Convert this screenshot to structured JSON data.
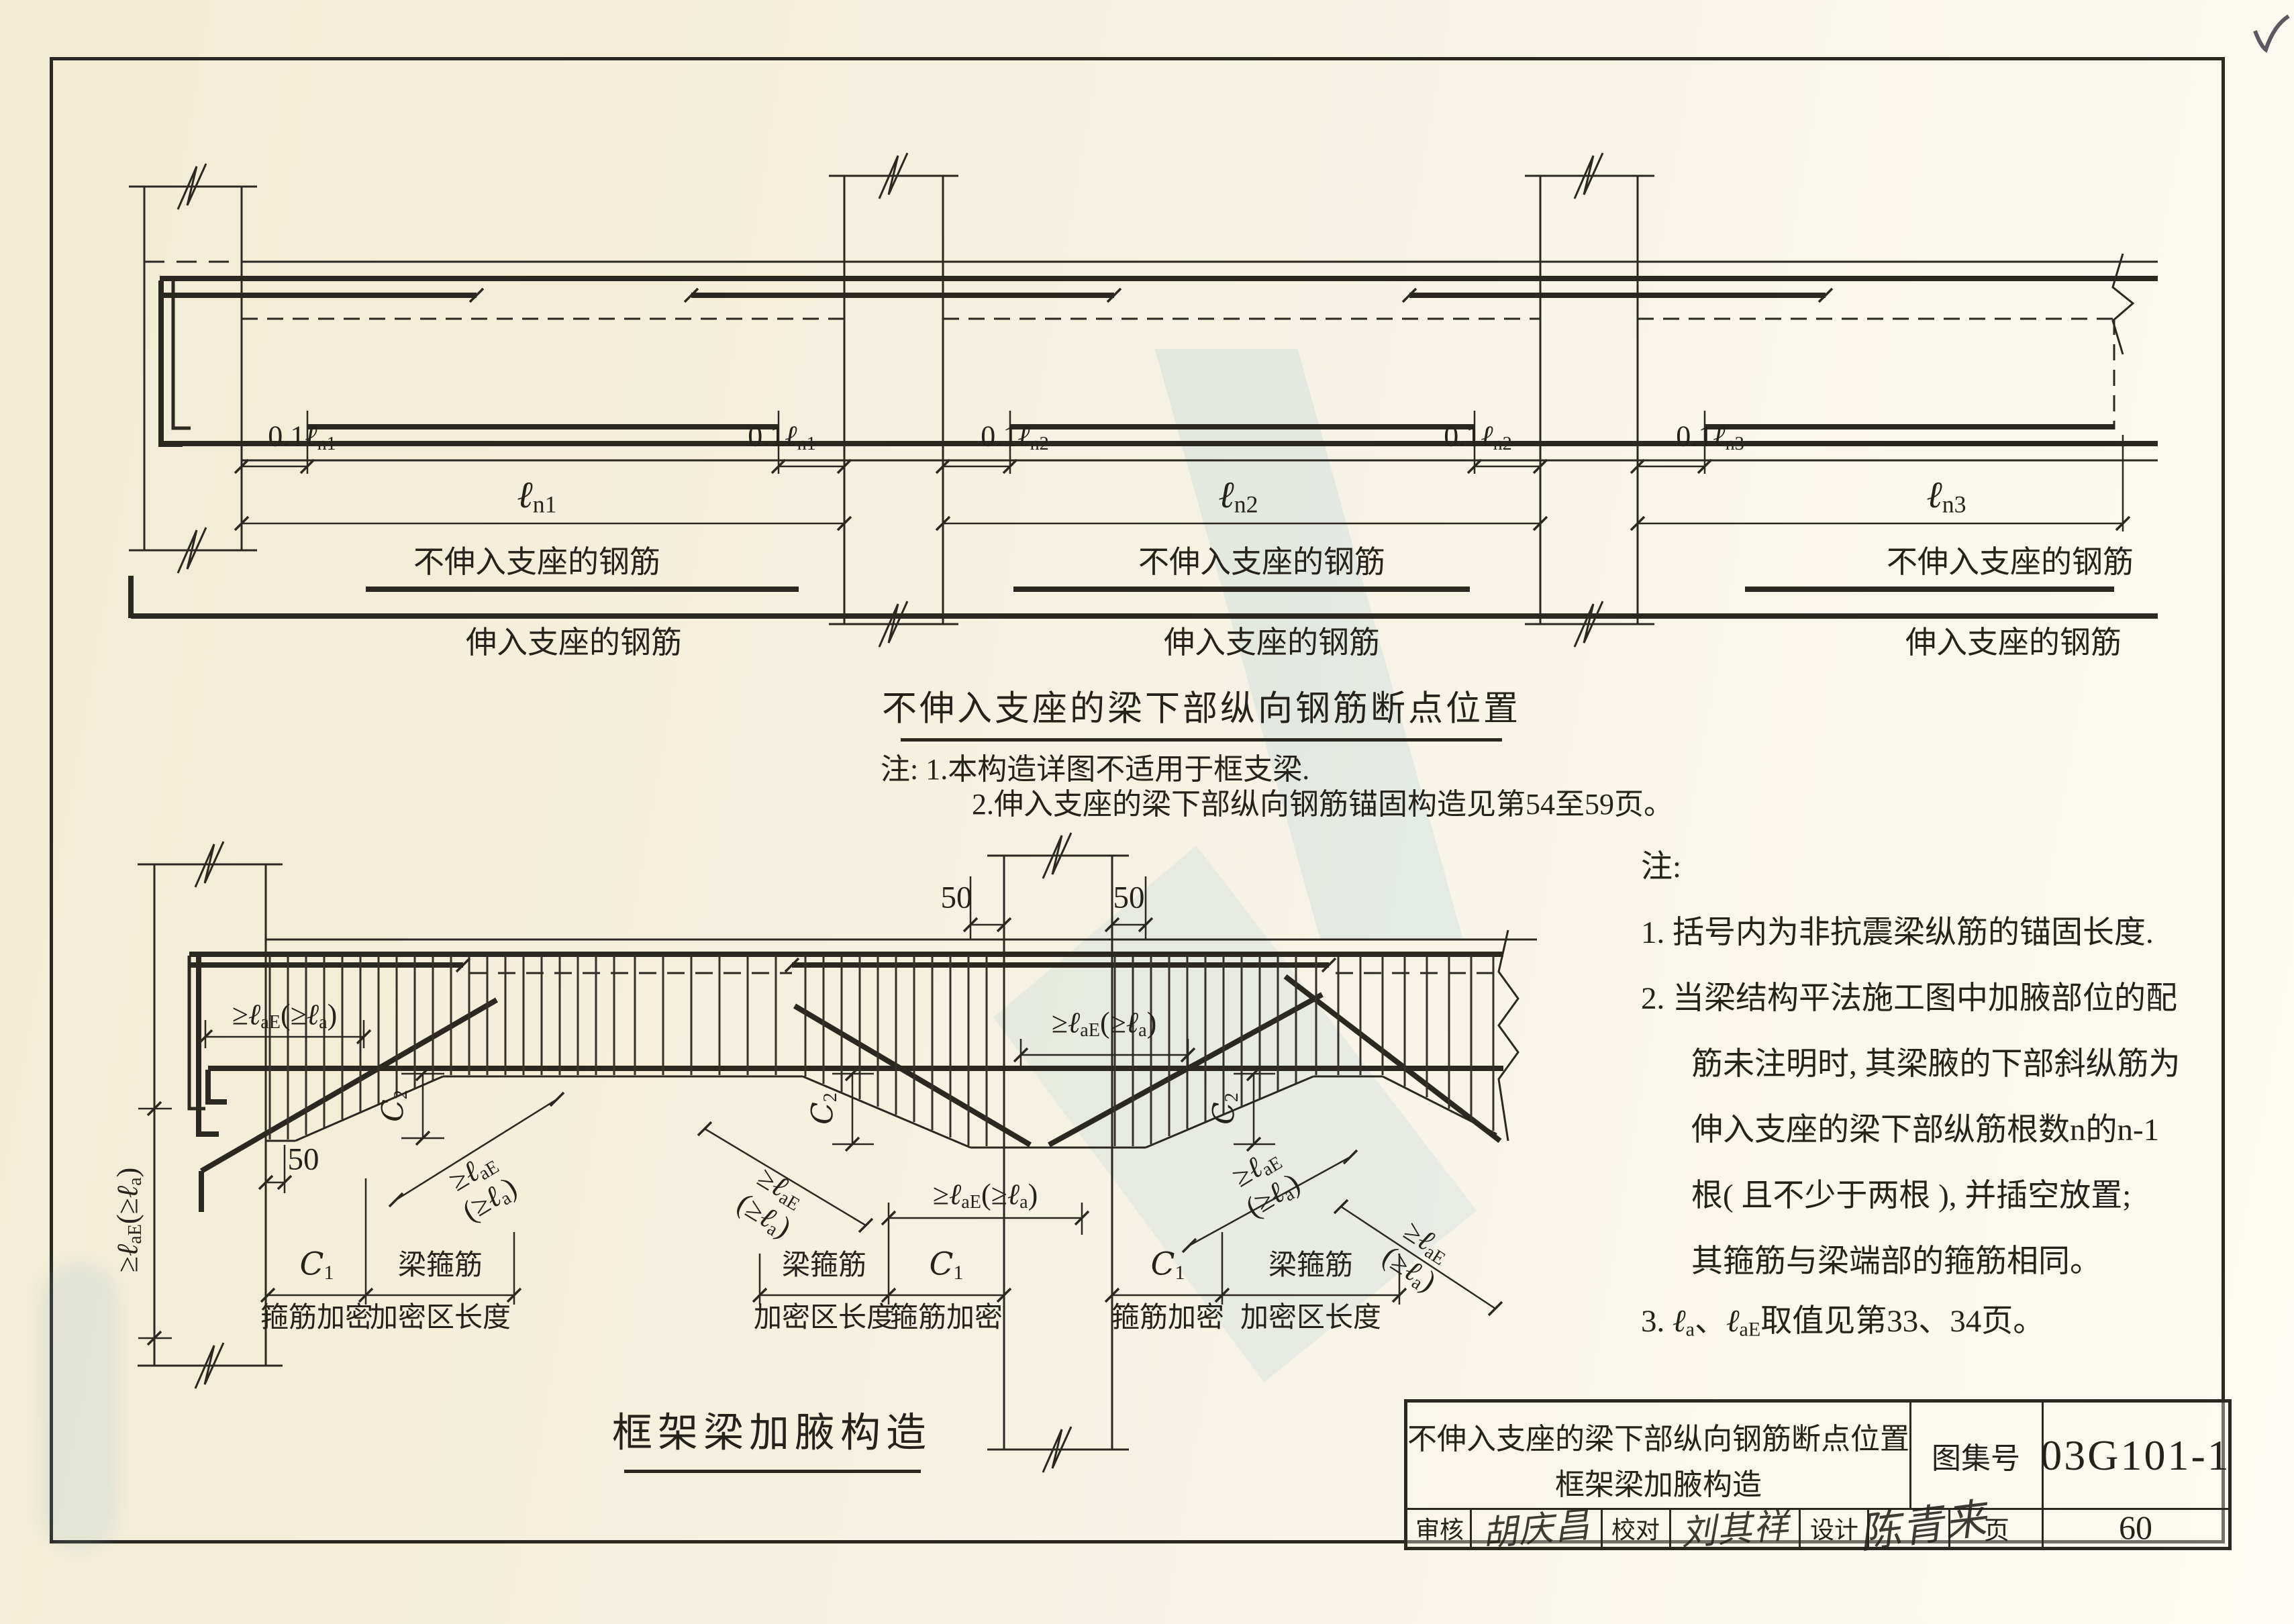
{
  "top_diagram": {
    "title": "不伸入支座的梁下部纵向钢筋断点位置",
    "notes_line1": "注: 1.本构造详图不适用于框支梁.",
    "notes_line2": "2.伸入支座的梁下部纵向钢筋锚固构造见第54至59页。",
    "rebar_not_into_support": "不伸入支座的钢筋",
    "rebar_into_support": "伸入支座的钢筋"
  },
  "bottom_diagram": {
    "title": "框架梁加腋构造",
    "stirrup_densify": "箍筋加密",
    "beam_stirrups": "梁箍筋",
    "densified_zone_length": "加密区长度"
  },
  "side_notes": {
    "prefix": "注:",
    "line1": "1. 括号内为非抗震梁纵筋的锚固长度.",
    "line2": "2. 当梁结构平法施工图中加腋部位的配",
    "line3": "筋未注明时, 其梁腋的下部斜纵筋为",
    "line4": "伸入支座的梁下部纵筋根数n的n-1",
    "line5": "根( 且不少于两根 ), 并插空放置;",
    "line6": "其箍筋与梁端部的箍筋相同。",
    "note3_parts": [
      [
        "3. "
      ],
      [
        "ℓ",
        "i"
      ],
      [
        "a",
        "s"
      ],
      [
        "、"
      ],
      [
        "ℓ",
        "i"
      ],
      [
        "aE",
        "s"
      ],
      [
        "取值见第33、34页。"
      ]
    ]
  },
  "glyphs": {
    "ln1": [
      [
        "ℓ",
        "i"
      ],
      [
        "n1",
        "s"
      ]
    ],
    "ln2": [
      [
        "ℓ",
        "i"
      ],
      [
        "n2",
        "s"
      ]
    ],
    "ln3": [
      [
        "ℓ",
        "i"
      ],
      [
        "n3",
        "s"
      ]
    ],
    "p01n1": [
      [
        "0.1"
      ],
      [
        "ℓ",
        "i"
      ],
      [
        "n1",
        "s"
      ]
    ],
    "p01n2": [
      [
        "0.1"
      ],
      [
        "ℓ",
        "i"
      ],
      [
        "n2",
        "s"
      ]
    ],
    "p01n3": [
      [
        "0.1"
      ],
      [
        "ℓ",
        "i"
      ],
      [
        "n3",
        "s"
      ]
    ],
    "laE_full": [
      [
        "≥"
      ],
      [
        "ℓ",
        "i"
      ],
      [
        "aE",
        "s"
      ],
      [
        "(≥"
      ],
      [
        "ℓ",
        "i"
      ],
      [
        "a",
        "s"
      ],
      [
        ")"
      ]
    ],
    "laE_line1": [
      [
        "≥"
      ],
      [
        "ℓ",
        "i"
      ],
      [
        "aE",
        "s"
      ]
    ],
    "laE_line2": [
      [
        "(≥"
      ],
      [
        "ℓ",
        "i"
      ],
      [
        "a",
        "s"
      ],
      [
        ")"
      ]
    ],
    "C1": [
      [
        "C",
        "i"
      ],
      [
        "1",
        "s"
      ]
    ],
    "C2": [
      [
        "C",
        "i"
      ],
      [
        "2",
        "s"
      ]
    ],
    "n50": [
      [
        "50"
      ]
    ]
  },
  "title_block": {
    "title_line1": "不伸入支座的梁下部纵向钢筋断点位置",
    "title_line2": "框架梁加腋构造",
    "atlas_label": "图集号",
    "atlas_number": "03G101-1",
    "page_label": "页",
    "page_number": "60",
    "reviewer_label": "审核",
    "reviewer_signature": "胡庆昌",
    "checker_label": "校对",
    "checker_signature": "刘其祥",
    "designer_label": "设计",
    "designer_signature": "陈青来"
  }
}
